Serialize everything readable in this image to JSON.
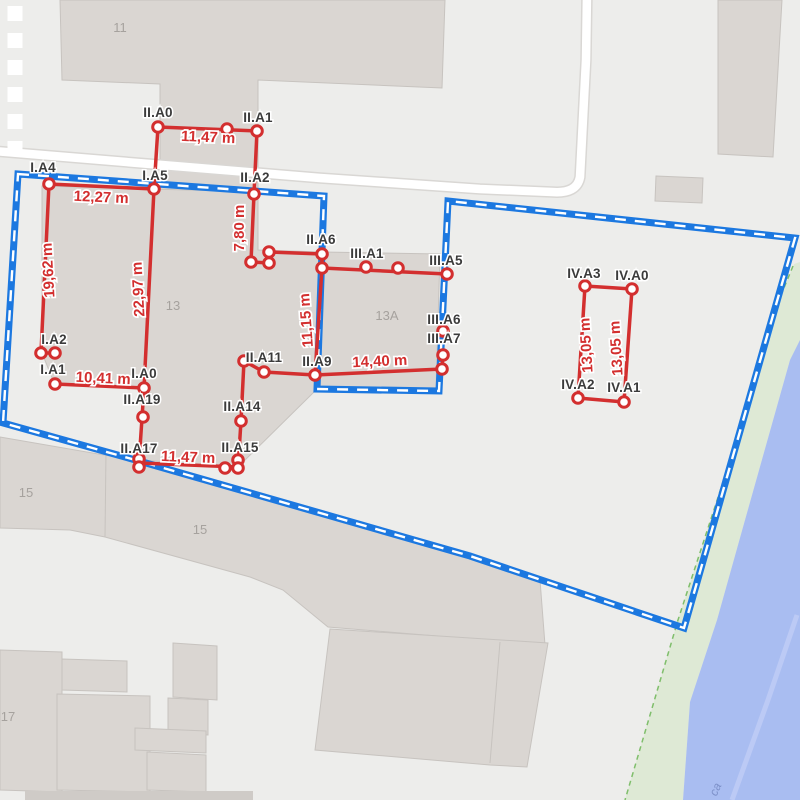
{
  "app": {
    "name": "parcel-measurement-map"
  },
  "colors": {
    "bg": "#EDEDEB",
    "building_fill": "#DAD6D2",
    "building_stroke": "#C7C3BF",
    "road": "#FFFFFF",
    "road_casing": "#D9D7D4",
    "boundary_blue": "#1C78E0",
    "boundary_dash": "#FFFFFF",
    "measure_red": "#D32F2F",
    "vertex_fill": "#FFFFFF",
    "river": "#A9BDF1",
    "river_stripe": "#BCCAF5",
    "green": "#DEE9D5",
    "green_edge": "#7FBE6B",
    "label_gray": "#A6A29E",
    "bottom_bar": "#CFCBC7"
  },
  "map": {
    "labels": [
      {
        "text": "11",
        "x": 120,
        "y": 32,
        "rotate": 0
      },
      {
        "text": "13",
        "x": 173,
        "y": 310,
        "rotate": 0
      },
      {
        "text": "13A",
        "x": 387,
        "y": 320,
        "rotate": 0
      },
      {
        "text": "15",
        "x": 26,
        "y": 497,
        "rotate": 0
      },
      {
        "text": "15",
        "x": 200,
        "y": 534,
        "rotate": 0
      },
      {
        "text": "17",
        "x": 8,
        "y": 721,
        "rotate": 0
      }
    ],
    "water_label": {
      "text": "ca",
      "x": 719,
      "y": 791,
      "rotate": -65
    },
    "buildings": [
      {
        "name": "building-11",
        "points": "60,0 445,0 442,88 258,80 258,196 160,192 160,84 62,80"
      },
      {
        "name": "building-13",
        "points": "42,186 258,192 258,250 322,252 316,390 238,467 139,460 144,388 55,385 42,353"
      },
      {
        "name": "building-13a",
        "points": "322,252 440,254 436,390 317,389"
      },
      {
        "name": "building-15-strip",
        "points": "0,437 139,461 470,557 540,580 545,645 328,627 283,590 250,577 105,537 70,530 0,528"
      },
      {
        "name": "building-lower-big",
        "points": "330,629 548,643 527,767 490,765 315,750"
      },
      {
        "name": "building-17-a",
        "points": "0,650 62,652 62,792 0,790"
      },
      {
        "name": "building-17-b",
        "points": "62,659 127,661 127,692 62,690"
      },
      {
        "name": "building-17-c",
        "points": "57,694 150,696 150,792 57,790"
      },
      {
        "name": "building-mid-a",
        "points": "173,643 217,646 217,700 173,697"
      },
      {
        "name": "building-mid-b",
        "points": "168,698 208,700 208,735 168,733"
      },
      {
        "name": "building-mid-c",
        "points": "135,728 206,731 206,753 135,750"
      },
      {
        "name": "building-mid-d",
        "points": "147,752 206,755 206,792 147,790"
      },
      {
        "name": "building-topright",
        "points": "718,0 782,0 773,157 718,154"
      },
      {
        "name": "building-small-ne",
        "points": "656,176 703,178 702,203 655,201"
      }
    ],
    "dividers": [
      [
        106,
        452,
        105,
        537
      ],
      [
        500,
        642,
        490,
        763
      ]
    ],
    "bottom_bar_points": "25,791 253,791 253,800 25,800",
    "road_path": "M -6,151 L 150,164 320,178 480,189 552,192 Q 577,194 580,177 L 586,60 587,-6",
    "crosswalk": {
      "x": 15,
      "y1": 6,
      "y2": 150
    },
    "green_points": "794,264 800,262 800,345 790,360 745,520 717,620 690,702 683,800 625,800 678,620 740,430 779,300",
    "green_edge_points": "793,266 779,300 740,430 678,620 625,800",
    "river_points": "800,340 790,360 745,520 717,620 690,702 683,800 800,800",
    "river_stripe_points": "797,615 768,700 732,800"
  },
  "survey": {
    "boundary_points": "18,174 324,196 317,389 439,391 448,201 795,238 684,628 470,556 139,461 3,423",
    "segments": [
      [
        158,
        127,
        257,
        131
      ],
      [
        158,
        127,
        154,
        189
      ],
      [
        257,
        131,
        254,
        194
      ],
      [
        49,
        184,
        154,
        189
      ],
      [
        49,
        184,
        41,
        353
      ],
      [
        154,
        189,
        144,
        388
      ],
      [
        41,
        353,
        55,
        353
      ],
      [
        55,
        384,
        144,
        388
      ],
      [
        144,
        388,
        139,
        463
      ],
      [
        254,
        194,
        251,
        262
      ],
      [
        251,
        262,
        269,
        263
      ],
      [
        269,
        252,
        269,
        263
      ],
      [
        269,
        252,
        322,
        254
      ],
      [
        322,
        254,
        322,
        268
      ],
      [
        322,
        268,
        447,
        274
      ],
      [
        322,
        268,
        315,
        375
      ],
      [
        315,
        375,
        442,
        369
      ],
      [
        244,
        361,
        264,
        372
      ],
      [
        264,
        372,
        315,
        375
      ],
      [
        244,
        361,
        241,
        421
      ],
      [
        241,
        421,
        238,
        468
      ],
      [
        139,
        463,
        238,
        467
      ],
      [
        443,
        355,
        442,
        369
      ],
      [
        585,
        286,
        632,
        289
      ],
      [
        585,
        286,
        578,
        398
      ],
      [
        632,
        289,
        624,
        402
      ],
      [
        578,
        398,
        624,
        402
      ]
    ],
    "points": [
      [
        158,
        127
      ],
      [
        227,
        129
      ],
      [
        257,
        131
      ],
      [
        49,
        184
      ],
      [
        154,
        189
      ],
      [
        254,
        194
      ],
      [
        251,
        262
      ],
      [
        269,
        252
      ],
      [
        269,
        263
      ],
      [
        322,
        254
      ],
      [
        322,
        268
      ],
      [
        366,
        267
      ],
      [
        398,
        268
      ],
      [
        447,
        274
      ],
      [
        443,
        331
      ],
      [
        443,
        355
      ],
      [
        442,
        369
      ],
      [
        41,
        353
      ],
      [
        55,
        353
      ],
      [
        55,
        384
      ],
      [
        144,
        388
      ],
      [
        143,
        417
      ],
      [
        244,
        361
      ],
      [
        264,
        372
      ],
      [
        315,
        375
      ],
      [
        241,
        421
      ],
      [
        139,
        459
      ],
      [
        139,
        467
      ],
      [
        225,
        468
      ],
      [
        238,
        460
      ],
      [
        238,
        468
      ],
      [
        585,
        286
      ],
      [
        632,
        289
      ],
      [
        578,
        398
      ],
      [
        624,
        402
      ]
    ],
    "point_labels": [
      {
        "text": "II.A0",
        "x": 158,
        "y": 117
      },
      {
        "text": "II.A1",
        "x": 258,
        "y": 122
      },
      {
        "text": "I.A4",
        "x": 43,
        "y": 172
      },
      {
        "text": "I.A5",
        "x": 155,
        "y": 180
      },
      {
        "text": "II.A2",
        "x": 255,
        "y": 182
      },
      {
        "text": "II.A6",
        "x": 321,
        "y": 244
      },
      {
        "text": "III.A1",
        "x": 367,
        "y": 258
      },
      {
        "text": "III.A5",
        "x": 446,
        "y": 265
      },
      {
        "text": "III.A6",
        "x": 444,
        "y": 324
      },
      {
        "text": "III.A7",
        "x": 444,
        "y": 343
      },
      {
        "text": "I.A2",
        "x": 54,
        "y": 344
      },
      {
        "text": "I.A1",
        "x": 53,
        "y": 374
      },
      {
        "text": "I.A0",
        "x": 144,
        "y": 378
      },
      {
        "text": "II.A19",
        "x": 142,
        "y": 404
      },
      {
        "text": "II.A11",
        "x": 264,
        "y": 362
      },
      {
        "text": "II.A9",
        "x": 317,
        "y": 366
      },
      {
        "text": "II.A14",
        "x": 242,
        "y": 411
      },
      {
        "text": "II.A17",
        "x": 139,
        "y": 453
      },
      {
        "text": "II.A15",
        "x": 240,
        "y": 452
      },
      {
        "text": "IV.A3",
        "x": 584,
        "y": 278
      },
      {
        "text": "IV.A0",
        "x": 632,
        "y": 280
      },
      {
        "text": "IV.A2",
        "x": 578,
        "y": 389
      },
      {
        "text": "IV.A1",
        "x": 624,
        "y": 392
      }
    ],
    "measurements": [
      {
        "text": "11,47 m",
        "x": 208,
        "y": 142,
        "rotate": 2.5
      },
      {
        "text": "12,27 m",
        "x": 101,
        "y": 202,
        "rotate": 2.5
      },
      {
        "text": "7,80 m",
        "x": 244,
        "y": 228,
        "rotate": -90
      },
      {
        "text": "19,62 m",
        "x": 53,
        "y": 270,
        "rotate": -93
      },
      {
        "text": "22,97 m",
        "x": 143,
        "y": 289,
        "rotate": -93
      },
      {
        "text": "11,15 m",
        "x": 311,
        "y": 320,
        "rotate": -94
      },
      {
        "text": "10,41 m",
        "x": 103,
        "y": 383,
        "rotate": 2.5
      },
      {
        "text": "14,40 m",
        "x": 380,
        "y": 366,
        "rotate": -2.5
      },
      {
        "text": "13,05 m",
        "x": 591,
        "y": 345,
        "rotate": -93.5
      },
      {
        "text": "13,05 m",
        "x": 621,
        "y": 348,
        "rotate": -93.5
      },
      {
        "text": "11,47 m",
        "x": 188,
        "y": 462,
        "rotate": 2.3
      }
    ]
  }
}
